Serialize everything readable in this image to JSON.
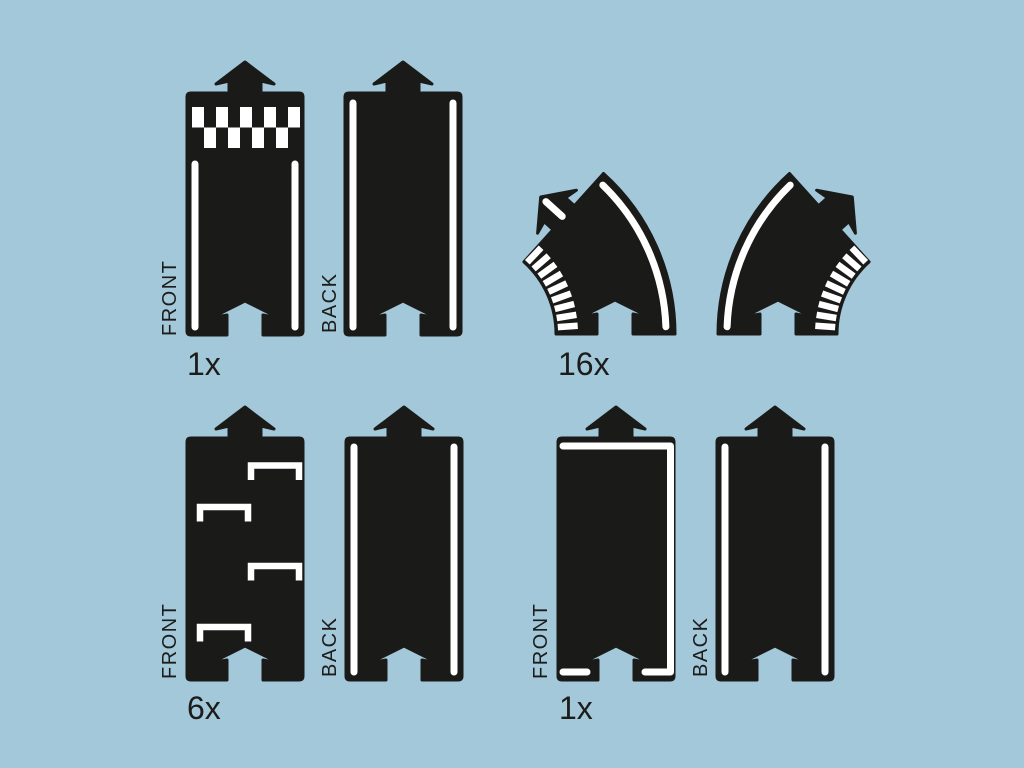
{
  "colors": {
    "background": "#a2c8da",
    "piece": "#1a1a19",
    "marking": "#ffffff",
    "ink": "#1c1c1b"
  },
  "groups": {
    "finish": {
      "count": "1x",
      "front_label": "FRONT",
      "back_label": "BACK"
    },
    "curve": {
      "count": "16x"
    },
    "parking": {
      "count": "6x",
      "front_label": "FRONT",
      "back_label": "BACK"
    },
    "junction": {
      "count": "1x",
      "front_label": "FRONT",
      "back_label": "BACK"
    }
  }
}
